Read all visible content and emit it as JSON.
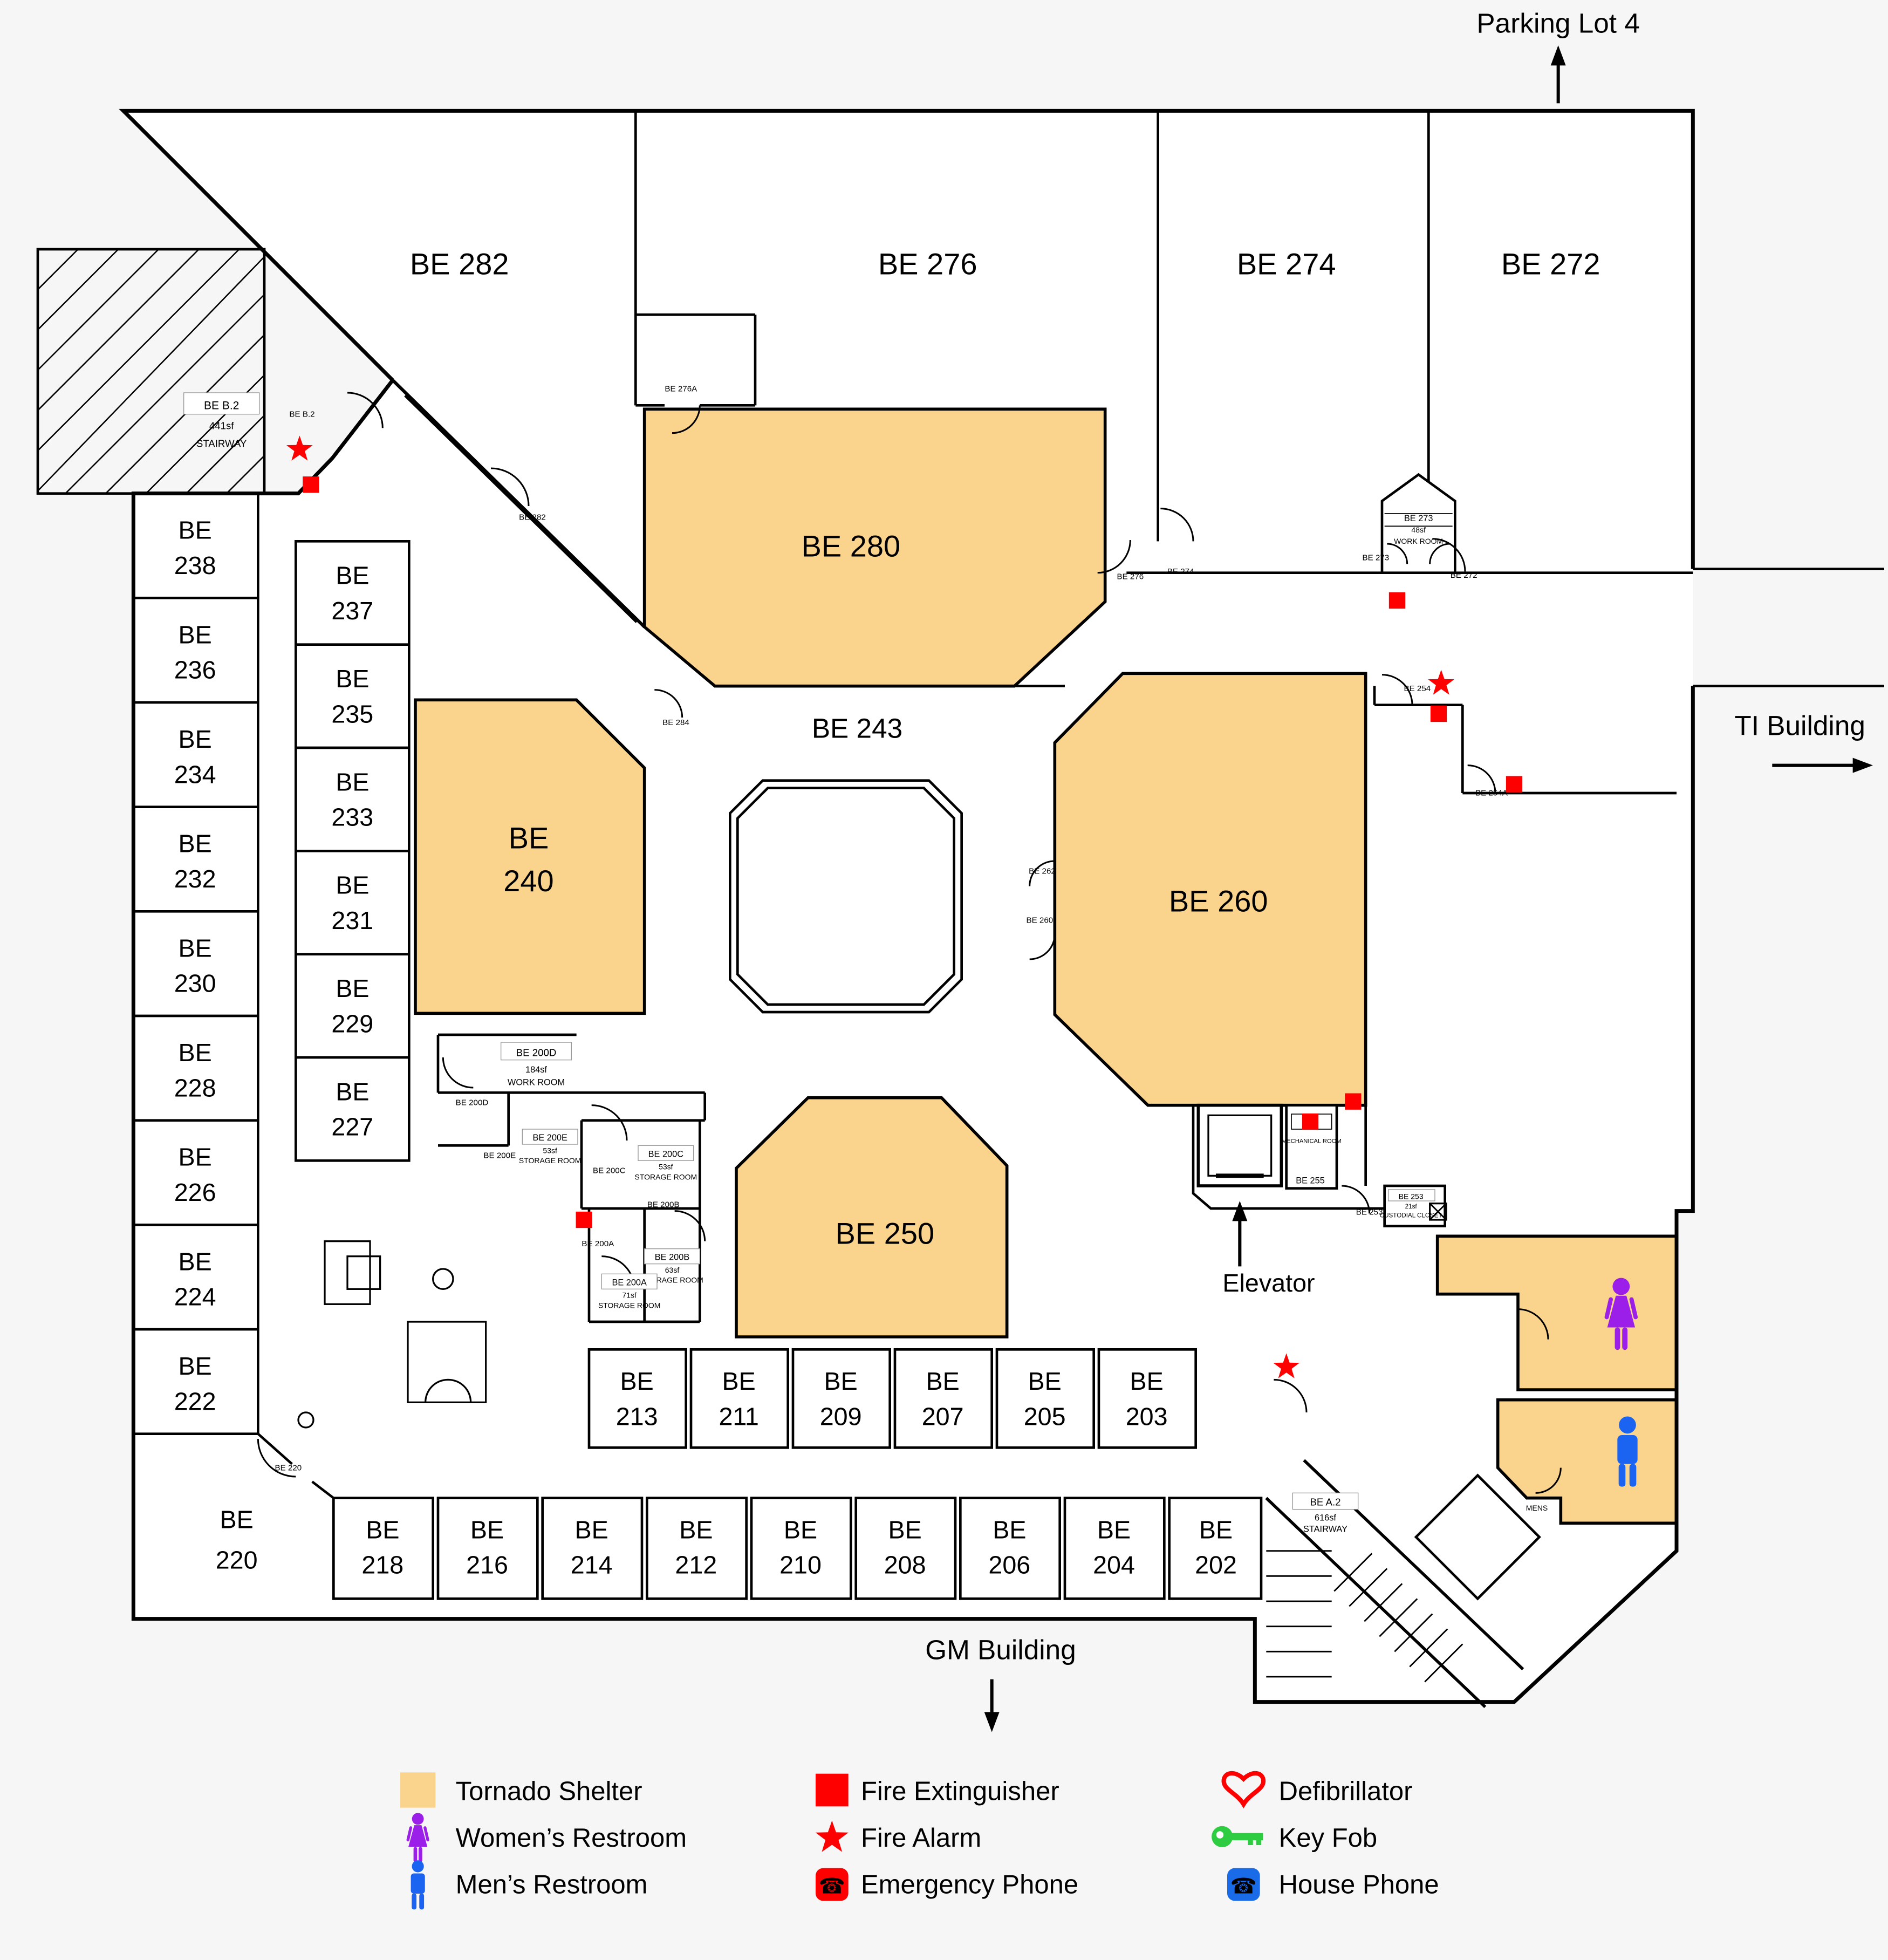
{
  "exterior": {
    "parking": "Parking Lot 4",
    "ti": "TI Building",
    "gm": "GM Building",
    "elevator": "Elevator"
  },
  "prefix": "BE",
  "big": {
    "r282": "BE 282",
    "r276": "BE 276",
    "r274": "BE 274",
    "r272": "BE 272",
    "r280": "BE 280",
    "r243": "BE 243",
    "r260": "BE 260",
    "r250": "BE 250",
    "r240l2": "240",
    "r220l2": "220"
  },
  "left_outer": [
    "238",
    "236",
    "234",
    "232",
    "230",
    "228",
    "226",
    "224",
    "222"
  ],
  "left_inner": [
    "237",
    "235",
    "233",
    "231",
    "229",
    "227"
  ],
  "row_upper": [
    "213",
    "211",
    "209",
    "207",
    "205",
    "203"
  ],
  "row_lower": [
    "218",
    "216",
    "214",
    "212",
    "210",
    "208",
    "206",
    "204",
    "202"
  ],
  "small": {
    "beb2": {
      "name": "BE B.2",
      "size": "441sf",
      "type": "STAIRWAY"
    },
    "bea2": {
      "name": "BE A.2",
      "size": "616sf",
      "type": "STAIRWAY"
    },
    "be273": {
      "name": "BE 273",
      "size": "48sf",
      "type": "WORK ROOM"
    },
    "be200d": {
      "name": "BE 200D",
      "size": "184sf",
      "type": "WORK ROOM"
    },
    "be200e": {
      "name": "BE 200E",
      "size": "53sf",
      "type": "STORAGE ROOM"
    },
    "be200c": {
      "name": "BE 200C",
      "size": "53sf",
      "type": "STORAGE ROOM"
    },
    "be200b": {
      "name": "BE 200B",
      "size": "63sf",
      "type": "STORAGE ROOM"
    },
    "be200a": {
      "name": "BE 200A",
      "size": "71sf",
      "type": "STORAGE ROOM"
    },
    "be253": {
      "name": "BE 253",
      "size": "21sf",
      "type": "CUSTODIAL CLOSET"
    },
    "mech": {
      "name": "MECHANICAL ROOM",
      "number": "BE 255"
    },
    "mens": "MENS"
  },
  "doors": {
    "beb2": "BE B.2",
    "be282": "BE 282",
    "be276a": "BE 276A",
    "be276": "BE 276",
    "be274": "BE 274",
    "be273": "BE 273",
    "be272": "BE 272",
    "be254": "BE 254",
    "be254a": "BE 254A",
    "be284": "BE 284",
    "be262": "BE 262",
    "be260": "BE 260",
    "be200d": "BE 200D",
    "be200e": "BE 200E",
    "be200c": "BE 200C",
    "be200b": "BE 200B",
    "be200a": "BE 200A",
    "be253": "BE 253",
    "be220": "BE 220"
  },
  "legend": {
    "col1": [
      {
        "icon": "tornado-shelter-swatch",
        "label": "Tornado Shelter"
      },
      {
        "icon": "womens-restroom-icon",
        "label": "Women’s Restroom"
      },
      {
        "icon": "mens-restroom-icon",
        "label": "Men’s Restroom"
      }
    ],
    "col2": [
      {
        "icon": "fire-extinguisher-icon",
        "label": "Fire Extinguisher"
      },
      {
        "icon": "fire-alarm-icon",
        "label": "Fire Alarm"
      },
      {
        "icon": "emergency-phone-icon",
        "label": "Emergency Phone"
      }
    ],
    "col3": [
      {
        "icon": "defibrillator-icon",
        "label": "Defibrillator"
      },
      {
        "icon": "key-fob-icon",
        "label": "Key Fob"
      },
      {
        "icon": "house-phone-icon",
        "label": "House Phone"
      }
    ]
  },
  "icons": {
    "phone_glyph": "☎"
  },
  "colors": {
    "shelter": "#FAD48C",
    "marker_red": "#FF0000",
    "womens_purple": "#9C1FE9",
    "mens_blue": "#1B64F2",
    "key_green": "#2ECC40",
    "house_phone_blue": "#1A6BE8",
    "wall": "#000000"
  },
  "map_markers": {
    "fire_extinguishers": 7,
    "fire_alarms": 3,
    "womens_restroom": 1,
    "mens_restroom": 1
  }
}
